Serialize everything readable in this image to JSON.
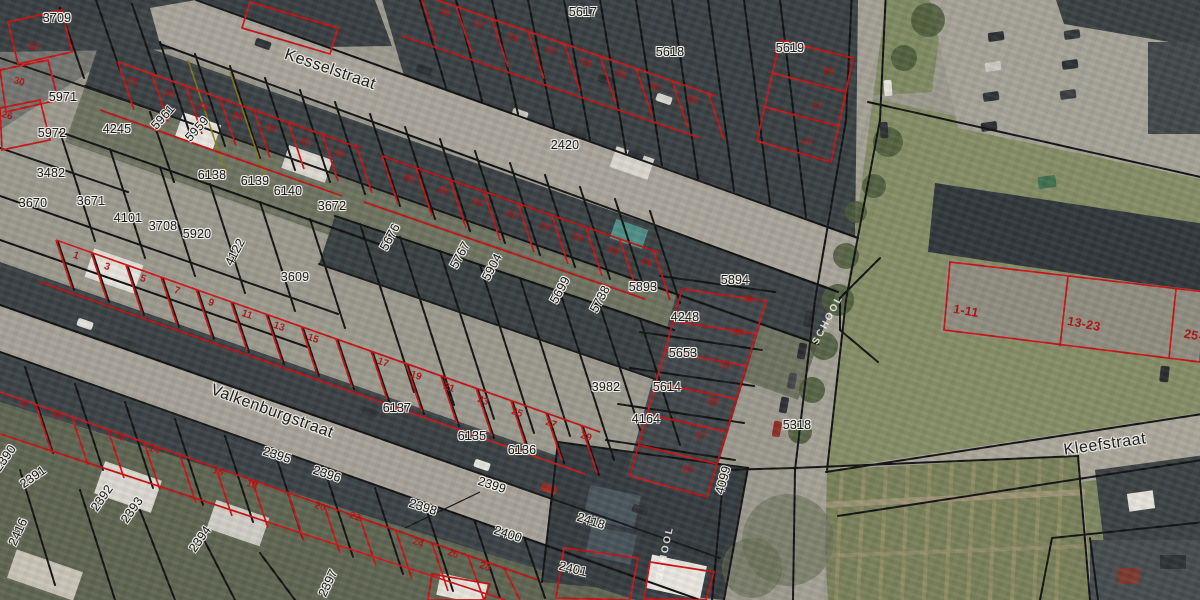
{
  "map": {
    "title": "cadastral aerial map",
    "streets": [
      {
        "t": "Kesselstraat",
        "x": 330,
        "y": 70,
        "r": 19
      },
      {
        "t": "Valkenburgstraat",
        "x": 272,
        "y": 412,
        "r": 20
      },
      {
        "t": "Kleefstraat",
        "x": 1105,
        "y": 445,
        "r": -8
      }
    ],
    "parcel_labels": [
      {
        "t": "3709",
        "x": 57,
        "y": 18,
        "r": 0
      },
      {
        "t": "5971",
        "x": 63,
        "y": 97,
        "r": 0
      },
      {
        "t": "5972",
        "x": 52,
        "y": 133,
        "r": 0
      },
      {
        "t": "3482",
        "x": 51,
        "y": 173,
        "r": 0
      },
      {
        "t": "3670",
        "x": 33,
        "y": 203,
        "r": 0
      },
      {
        "t": "3671",
        "x": 91,
        "y": 201,
        "r": 0
      },
      {
        "t": "4245",
        "x": 117,
        "y": 129,
        "r": 0
      },
      {
        "t": "5961",
        "x": 163,
        "y": 117,
        "r": -48
      },
      {
        "t": "5959",
        "x": 197,
        "y": 129,
        "r": -48
      },
      {
        "t": "6138",
        "x": 212,
        "y": 175,
        "r": 0
      },
      {
        "t": "6139",
        "x": 255,
        "y": 181,
        "r": 0
      },
      {
        "t": "6140",
        "x": 288,
        "y": 191,
        "r": 0
      },
      {
        "t": "3672",
        "x": 332,
        "y": 206,
        "r": 0
      },
      {
        "t": "4101",
        "x": 128,
        "y": 218,
        "r": 0
      },
      {
        "t": "3708",
        "x": 163,
        "y": 226,
        "r": 0
      },
      {
        "t": "5920",
        "x": 197,
        "y": 234,
        "r": 0
      },
      {
        "t": "4122",
        "x": 235,
        "y": 252,
        "r": -62
      },
      {
        "t": "3609",
        "x": 295,
        "y": 277,
        "r": 0
      },
      {
        "t": "5676",
        "x": 390,
        "y": 237,
        "r": -62
      },
      {
        "t": "5767",
        "x": 460,
        "y": 255,
        "r": -62
      },
      {
        "t": "5904",
        "x": 492,
        "y": 267,
        "r": -62
      },
      {
        "t": "5699",
        "x": 560,
        "y": 290,
        "r": -62
      },
      {
        "t": "5738",
        "x": 600,
        "y": 299,
        "r": -62
      },
      {
        "t": "5893",
        "x": 643,
        "y": 287,
        "r": 0
      },
      {
        "t": "5894",
        "x": 735,
        "y": 280,
        "r": 0
      },
      {
        "t": "4248",
        "x": 685,
        "y": 317,
        "r": 0
      },
      {
        "t": "5653",
        "x": 683,
        "y": 353,
        "r": 0
      },
      {
        "t": "3982",
        "x": 606,
        "y": 387,
        "r": 0
      },
      {
        "t": "5614",
        "x": 667,
        "y": 387,
        "r": 0
      },
      {
        "t": "4164",
        "x": 646,
        "y": 419,
        "r": 0
      },
      {
        "t": "5318",
        "x": 797,
        "y": 425,
        "r": 0
      },
      {
        "t": "4099",
        "x": 723,
        "y": 480,
        "r": -75
      },
      {
        "t": "5617",
        "x": 583,
        "y": 12,
        "r": 0
      },
      {
        "t": "5618",
        "x": 670,
        "y": 52,
        "r": 0
      },
      {
        "t": "5619",
        "x": 790,
        "y": 48,
        "r": 0
      },
      {
        "t": "2420",
        "x": 565,
        "y": 145,
        "r": 0
      },
      {
        "t": "6137",
        "x": 397,
        "y": 408,
        "r": 0
      },
      {
        "t": "6135",
        "x": 472,
        "y": 436,
        "r": 0
      },
      {
        "t": "6136",
        "x": 522,
        "y": 450,
        "r": 0
      },
      {
        "t": "2395",
        "x": 277,
        "y": 455,
        "r": 18
      },
      {
        "t": "2396",
        "x": 327,
        "y": 474,
        "r": 18
      },
      {
        "t": "2390",
        "x": 5,
        "y": 458,
        "r": -55
      },
      {
        "t": "2391",
        "x": 33,
        "y": 477,
        "r": -35
      },
      {
        "t": "2392",
        "x": 102,
        "y": 498,
        "r": -55
      },
      {
        "t": "2393",
        "x": 132,
        "y": 510,
        "r": -55
      },
      {
        "t": "2394",
        "x": 200,
        "y": 539,
        "r": -55
      },
      {
        "t": "2416",
        "x": 18,
        "y": 532,
        "r": -65
      },
      {
        "t": "2397",
        "x": 328,
        "y": 583,
        "r": -65
      },
      {
        "t": "2398",
        "x": 423,
        "y": 507,
        "r": 18
      },
      {
        "t": "2399",
        "x": 492,
        "y": 485,
        "r": 18
      },
      {
        "t": "2400",
        "x": 508,
        "y": 534,
        "r": 18
      },
      {
        "t": "2418",
        "x": 591,
        "y": 521,
        "r": 18
      },
      {
        "t": "2401",
        "x": 573,
        "y": 569,
        "r": 14
      }
    ],
    "house_numbers": [
      {
        "t": "32",
        "x": 33,
        "y": 47,
        "r": 15
      },
      {
        "t": "30",
        "x": 19,
        "y": 82,
        "r": 15
      },
      {
        "t": "26",
        "x": 7,
        "y": 116,
        "r": 15
      },
      {
        "t": "32",
        "x": 133,
        "y": 82,
        "r": 19
      },
      {
        "t": "34",
        "x": 169,
        "y": 94,
        "r": 19
      },
      {
        "t": "36",
        "x": 203,
        "y": 107,
        "r": 19
      },
      {
        "t": "38",
        "x": 237,
        "y": 117,
        "r": 19
      },
      {
        "t": "40",
        "x": 271,
        "y": 129,
        "r": 19
      },
      {
        "t": "42",
        "x": 305,
        "y": 142,
        "r": 19
      },
      {
        "t": "44",
        "x": 339,
        "y": 154,
        "r": 19
      },
      {
        "t": "46",
        "x": 409,
        "y": 179,
        "r": 19
      },
      {
        "t": "48",
        "x": 443,
        "y": 191,
        "r": 19
      },
      {
        "t": "50",
        "x": 477,
        "y": 203,
        "r": 19
      },
      {
        "t": "52",
        "x": 511,
        "y": 215,
        "r": 19
      },
      {
        "t": "54",
        "x": 545,
        "y": 227,
        "r": 19
      },
      {
        "t": "56",
        "x": 578,
        "y": 238,
        "r": 19
      },
      {
        "t": "58",
        "x": 613,
        "y": 251,
        "r": 19
      },
      {
        "t": "60",
        "x": 647,
        "y": 263,
        "r": 19
      },
      {
        "t": "55",
        "x": 445,
        "y": 13,
        "r": 19
      },
      {
        "t": "57",
        "x": 479,
        "y": 25,
        "r": 19
      },
      {
        "t": "59",
        "x": 513,
        "y": 38,
        "r": 19
      },
      {
        "t": "61",
        "x": 551,
        "y": 51,
        "r": 19
      },
      {
        "t": "63",
        "x": 586,
        "y": 63,
        "r": 19
      },
      {
        "t": "65",
        "x": 621,
        "y": 75,
        "r": 19
      },
      {
        "t": "67",
        "x": 656,
        "y": 88,
        "r": 19
      },
      {
        "t": "69",
        "x": 692,
        "y": 100,
        "r": 19
      },
      {
        "t": "39",
        "x": 828,
        "y": 72,
        "r": 0
      },
      {
        "t": "37",
        "x": 817,
        "y": 107,
        "r": 0
      },
      {
        "t": "41",
        "x": 807,
        "y": 142,
        "r": 0
      },
      {
        "t": "1",
        "x": 76,
        "y": 256,
        "r": 19
      },
      {
        "t": "3",
        "x": 107,
        "y": 267,
        "r": 19
      },
      {
        "t": "5",
        "x": 143,
        "y": 279,
        "r": 19
      },
      {
        "t": "7",
        "x": 177,
        "y": 291,
        "r": 19
      },
      {
        "t": "9",
        "x": 211,
        "y": 303,
        "r": 19
      },
      {
        "t": "11",
        "x": 247,
        "y": 315,
        "r": 19
      },
      {
        "t": "13",
        "x": 279,
        "y": 327,
        "r": 19
      },
      {
        "t": "15",
        "x": 313,
        "y": 339,
        "r": 19
      },
      {
        "t": "17",
        "x": 383,
        "y": 363,
        "r": 19
      },
      {
        "t": "19",
        "x": 416,
        "y": 376,
        "r": 19
      },
      {
        "t": "21",
        "x": 449,
        "y": 388,
        "r": 19
      },
      {
        "t": "23",
        "x": 483,
        "y": 401,
        "r": 19
      },
      {
        "t": "25",
        "x": 517,
        "y": 413,
        "r": 19
      },
      {
        "t": "27",
        "x": 551,
        "y": 424,
        "r": 19
      },
      {
        "t": "29",
        "x": 586,
        "y": 437,
        "r": 19
      },
      {
        "t": "8",
        "x": 23,
        "y": 404,
        "r": 19
      },
      {
        "t": "10",
        "x": 57,
        "y": 415,
        "r": 19
      },
      {
        "t": "12",
        "x": 120,
        "y": 437,
        "r": 19
      },
      {
        "t": "14",
        "x": 154,
        "y": 450,
        "r": 19
      },
      {
        "t": "16",
        "x": 218,
        "y": 472,
        "r": 19
      },
      {
        "t": "18",
        "x": 252,
        "y": 485,
        "r": 19
      },
      {
        "t": "20",
        "x": 320,
        "y": 507,
        "r": 19
      },
      {
        "t": "22",
        "x": 355,
        "y": 517,
        "r": 19
      },
      {
        "t": "24",
        "x": 418,
        "y": 543,
        "r": 19
      },
      {
        "t": "26",
        "x": 453,
        "y": 554,
        "r": 19
      },
      {
        "t": "28",
        "x": 485,
        "y": 567,
        "r": 19
      },
      {
        "t": "35",
        "x": 749,
        "y": 300,
        "r": 0
      },
      {
        "t": "33",
        "x": 738,
        "y": 333,
        "r": 0
      },
      {
        "t": "31",
        "x": 725,
        "y": 366,
        "r": 0
      },
      {
        "t": "29",
        "x": 713,
        "y": 402,
        "r": 0
      },
      {
        "t": "27",
        "x": 701,
        "y": 436,
        "r": 0
      },
      {
        "t": "25",
        "x": 688,
        "y": 470,
        "r": 0
      }
    ],
    "range_labels": [
      {
        "t": "1-11",
        "x": 966,
        "y": 311,
        "r": 10
      },
      {
        "t": "13-23",
        "x": 1084,
        "y": 324,
        "r": 11
      },
      {
        "t": "25-3",
        "x": 1197,
        "y": 336,
        "r": 11
      }
    ],
    "road_markings": [
      {
        "t": "SCHOOL",
        "x": 828,
        "y": 320,
        "r": -62
      },
      {
        "t": "SCHOOL",
        "x": 665,
        "y": 553,
        "r": -78
      }
    ],
    "colors": {
      "boundary_black": "#121212",
      "boundary_red": "#cc1111",
      "boundary_yellow": "#8a7a10",
      "label_halo": "#f3f2ec",
      "house_number_red": "#ad1414"
    }
  }
}
